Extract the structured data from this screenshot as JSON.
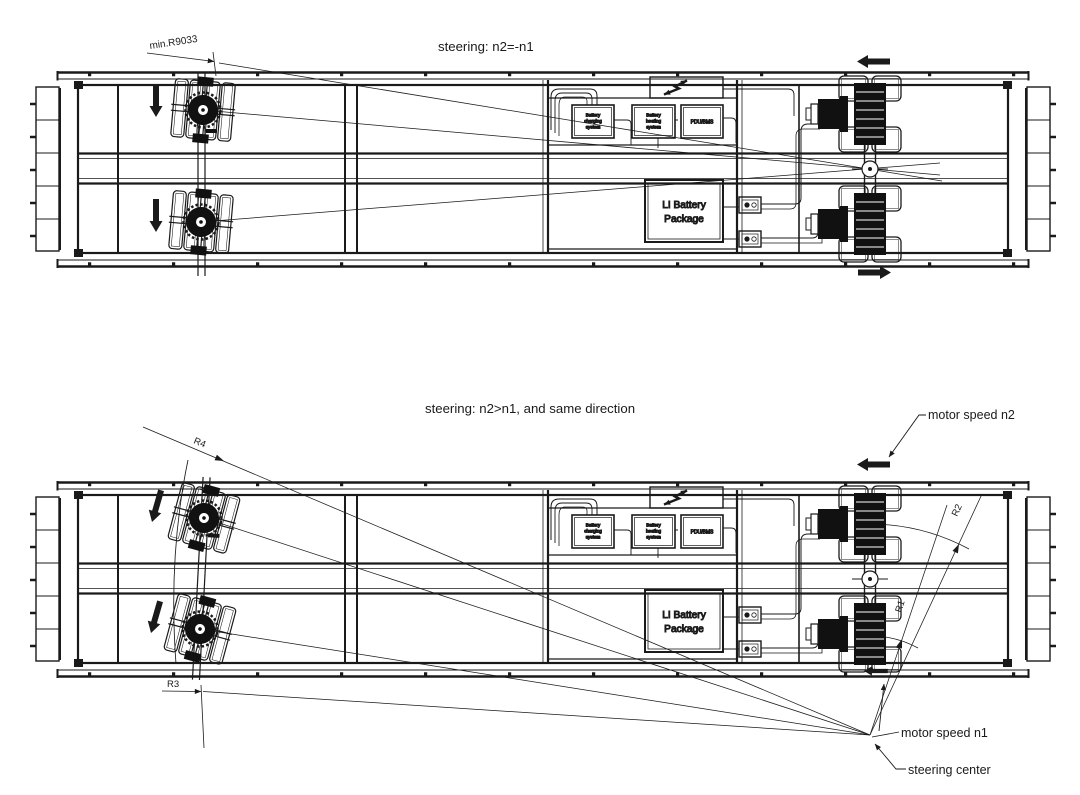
{
  "drawing": {
    "top": {
      "title": "steering: n2=-n1",
      "min_radius_label": "min.R9033"
    },
    "bottom": {
      "title": "steering: n2>n1, and  same direction",
      "r1": "R1",
      "r2": "R2",
      "r3": "R3",
      "r4": "R4",
      "motor_speed_n2": "motor speed n2",
      "motor_speed_n1": "motor speed n1",
      "steering_center": "steering center"
    },
    "components": {
      "battery_charging": {
        "l1": "Battery",
        "l2": "charging",
        "l3": "system"
      },
      "battery_heating": {
        "l1": "Battery",
        "l2": "heating",
        "l3": "system"
      },
      "pdu_bms": "PDU/BMS",
      "li_battery": {
        "l1": "LI Battery",
        "l2": "Package"
      }
    },
    "colors": {
      "line": "#1a1a1a",
      "fill_dark": "#111111",
      "background": "#ffffff"
    }
  }
}
